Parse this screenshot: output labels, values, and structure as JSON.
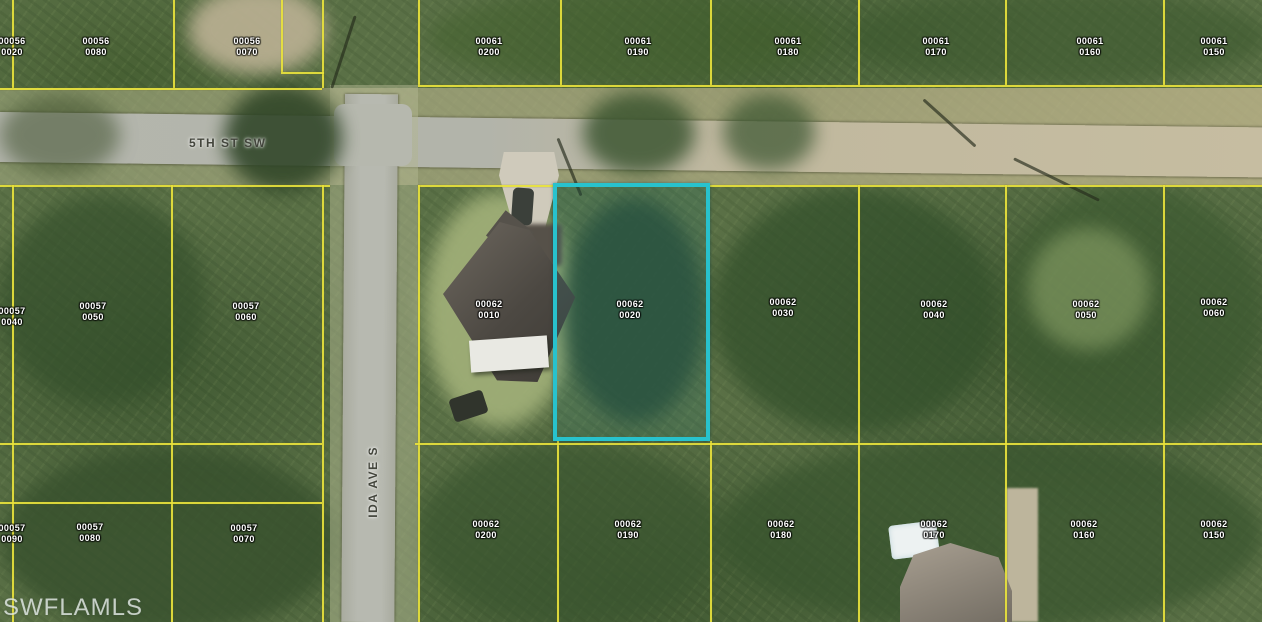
{
  "watermark": "SWFLAMLS",
  "streets": [
    {
      "name": "5TH ST SW",
      "orientation": "horizontal"
    },
    {
      "name": "IDA AVE S",
      "orientation": "vertical"
    }
  ],
  "highlight": {
    "block": "00062",
    "lot": "0020",
    "color": "#28c2cd"
  },
  "colors": {
    "parcel_line": "#e8e23c",
    "label_text": "#ffffff"
  },
  "parcels": [
    {
      "block": "00056",
      "lot": "0020",
      "x": 12,
      "y": 36,
      "highlighted": false
    },
    {
      "block": "00056",
      "lot": "0080",
      "x": 96,
      "y": 36,
      "highlighted": false
    },
    {
      "block": "00056",
      "lot": "0070",
      "x": 247,
      "y": 36,
      "highlighted": false
    },
    {
      "block": "00061",
      "lot": "0200",
      "x": 489,
      "y": 36,
      "highlighted": false
    },
    {
      "block": "00061",
      "lot": "0190",
      "x": 638,
      "y": 36,
      "highlighted": false
    },
    {
      "block": "00061",
      "lot": "0180",
      "x": 788,
      "y": 36,
      "highlighted": false
    },
    {
      "block": "00061",
      "lot": "0170",
      "x": 936,
      "y": 36,
      "highlighted": false
    },
    {
      "block": "00061",
      "lot": "0160",
      "x": 1090,
      "y": 36,
      "highlighted": false
    },
    {
      "block": "00061",
      "lot": "0150",
      "x": 1214,
      "y": 36,
      "highlighted": false
    },
    {
      "block": "00057",
      "lot": "0040",
      "x": 12,
      "y": 306,
      "highlighted": false
    },
    {
      "block": "00057",
      "lot": "0050",
      "x": 93,
      "y": 301,
      "highlighted": false
    },
    {
      "block": "00057",
      "lot": "0060",
      "x": 246,
      "y": 301,
      "highlighted": false
    },
    {
      "block": "00062",
      "lot": "0010",
      "x": 489,
      "y": 299,
      "highlighted": false
    },
    {
      "block": "00062",
      "lot": "0020",
      "x": 630,
      "y": 299,
      "highlighted": true
    },
    {
      "block": "00062",
      "lot": "0030",
      "x": 783,
      "y": 297,
      "highlighted": false
    },
    {
      "block": "00062",
      "lot": "0040",
      "x": 934,
      "y": 299,
      "highlighted": false
    },
    {
      "block": "00062",
      "lot": "0050",
      "x": 1086,
      "y": 299,
      "highlighted": false
    },
    {
      "block": "00062",
      "lot": "0060",
      "x": 1214,
      "y": 297,
      "highlighted": false
    },
    {
      "block": "00057",
      "lot": "0090",
      "x": 12,
      "y": 523,
      "highlighted": false
    },
    {
      "block": "00057",
      "lot": "0080",
      "x": 90,
      "y": 522,
      "highlighted": false
    },
    {
      "block": "00057",
      "lot": "0070",
      "x": 244,
      "y": 523,
      "highlighted": false
    },
    {
      "block": "00062",
      "lot": "0200",
      "x": 486,
      "y": 519,
      "highlighted": false
    },
    {
      "block": "00062",
      "lot": "0190",
      "x": 628,
      "y": 519,
      "highlighted": false
    },
    {
      "block": "00062",
      "lot": "0180",
      "x": 781,
      "y": 519,
      "highlighted": false
    },
    {
      "block": "00062",
      "lot": "0170",
      "x": 934,
      "y": 519,
      "highlighted": false
    },
    {
      "block": "00062",
      "lot": "0160",
      "x": 1084,
      "y": 519,
      "highlighted": false
    },
    {
      "block": "00062",
      "lot": "0150",
      "x": 1214,
      "y": 519,
      "highlighted": false
    }
  ]
}
